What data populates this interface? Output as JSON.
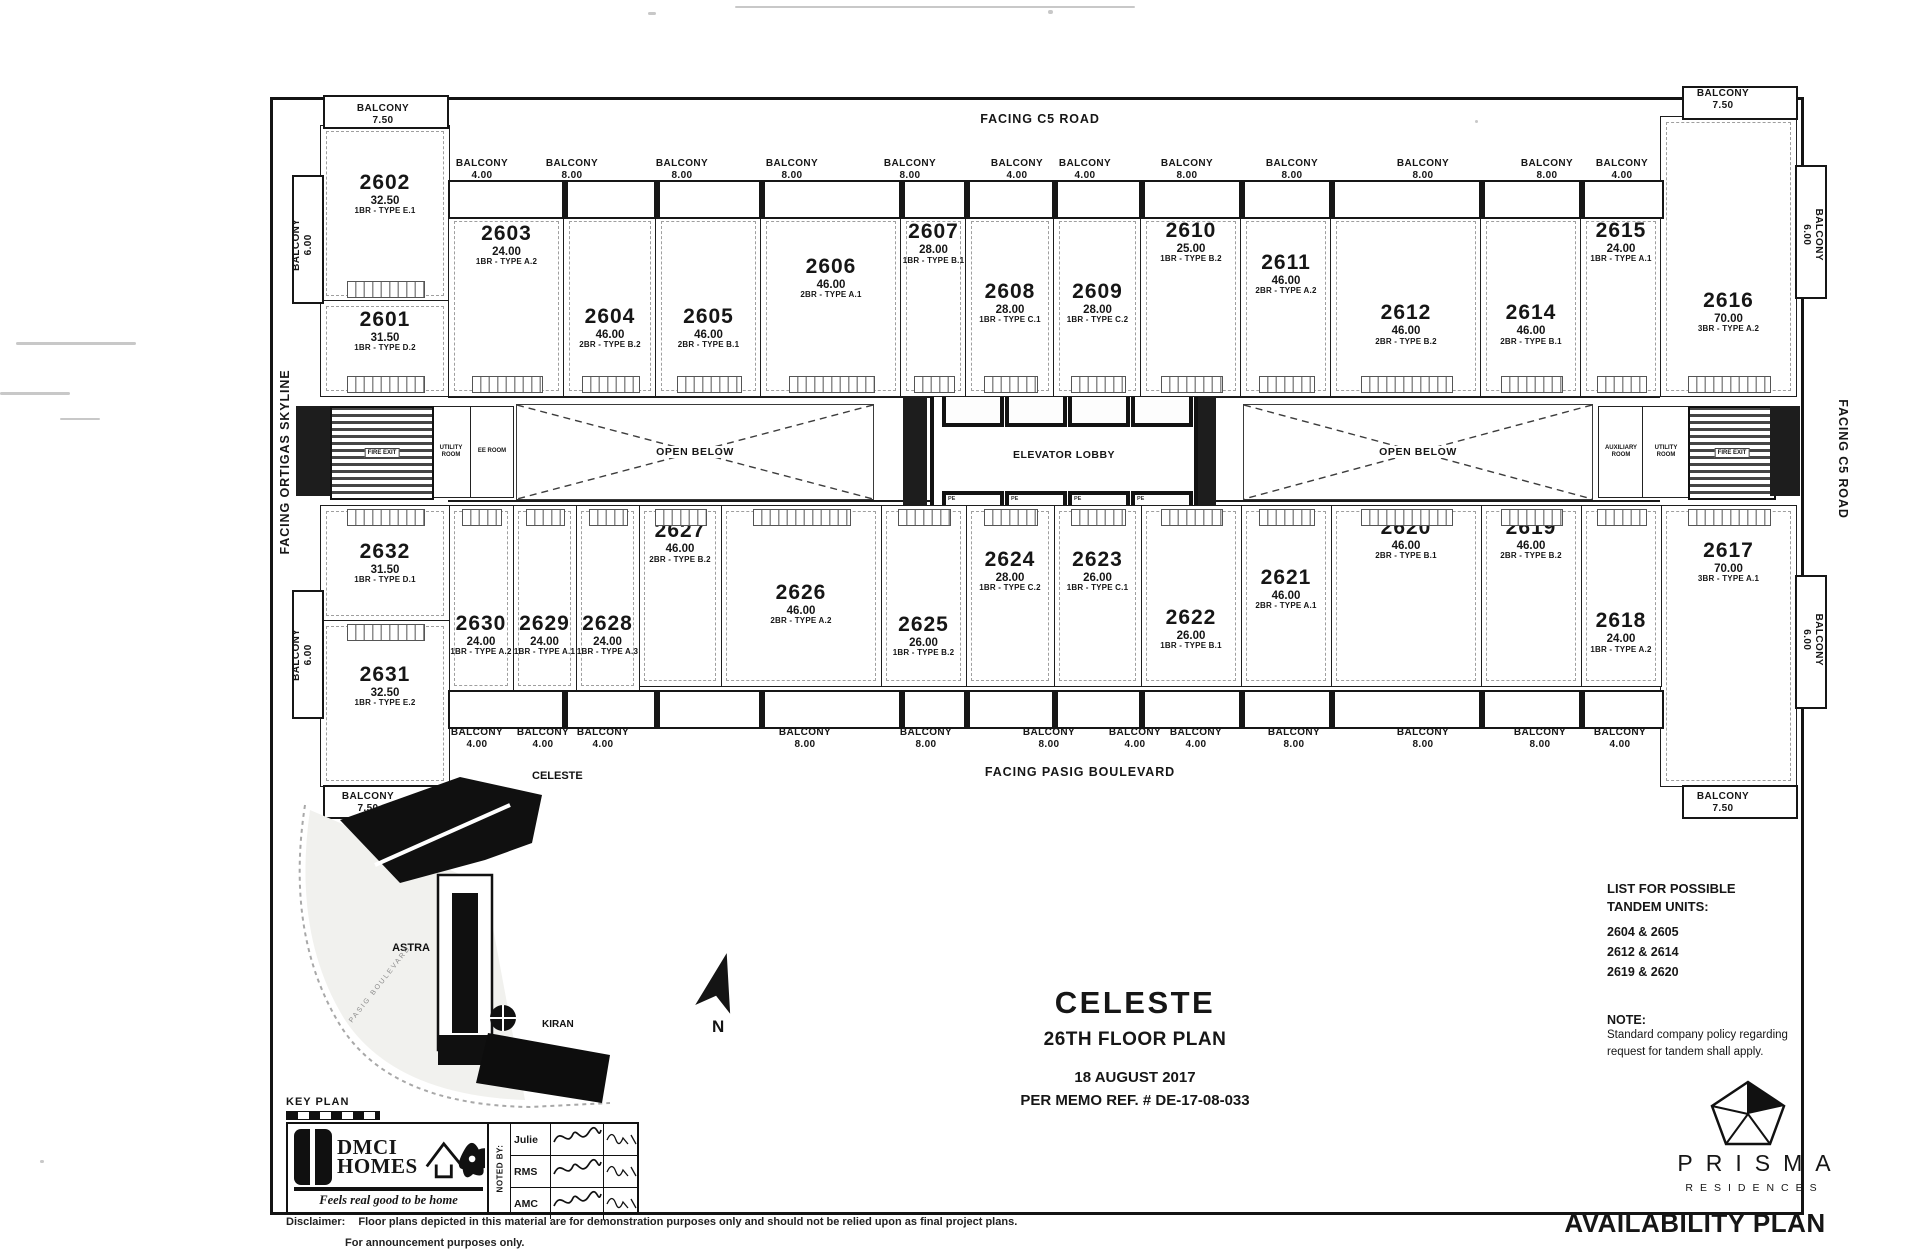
{
  "labels": {
    "balcony_word": "BALCONY",
    "elevator_lobby": "ELEVATOR LOBBY",
    "open_below": "OPEN BELOW",
    "fire_exit": "FIRE EXIT",
    "elevator_cell": "PE"
  },
  "orientation": {
    "top": "FACING C5 ROAD",
    "bottom": "FACING PASIG BOULEVARD",
    "left": "FACING ORTIGAS SKYLINE",
    "right": "FACING C5 ROAD"
  },
  "title_block": {
    "tower": "CELESTE",
    "floor": "26TH FLOOR PLAN",
    "date": "18 AUGUST 2017",
    "memo": "PER MEMO REF. #  DE-17-08-033"
  },
  "tandem": {
    "title_line1": "LIST FOR POSSIBLE",
    "title_line2": "TANDEM UNITS:",
    "pairs": [
      "2604 & 2605",
      "2612 & 2614",
      "2619 & 2620"
    ],
    "note_label": "NOTE:",
    "note_line1": "Standard company policy regarding",
    "note_line2": "request for tandem shall apply."
  },
  "key_plan": {
    "label": "KEY PLAN",
    "celeste": "CELESTE",
    "astra": "ASTRA",
    "kiran": "KIRAN",
    "street": "PASIG BOULEVARD",
    "north": "N"
  },
  "branding": {
    "dmci_line1": "DMCI",
    "dmci_line2": "HOMES",
    "dmci_tagline": "Feels real good to be home",
    "noted_by": "NOTED BY:",
    "noted_rows": [
      "Julie",
      "RMS",
      "AMC"
    ],
    "prisma": "PRISMA",
    "prisma_sub": "RESIDENCES",
    "availability": "AVAILABILITY PLAN"
  },
  "disclaimer": {
    "label": "Disclaimer:",
    "line1": "Floor plans depicted in this material are for demonstration purposes only and should not be relied upon as final project plans.",
    "line2": "For announcement purposes only."
  },
  "plan": {
    "units": [
      {
        "n": "2602",
        "a": "32.50",
        "t": "1BR - TYPE E.1",
        "x": 320,
        "y": 125,
        "w": 128,
        "h": 175,
        "ly": 26,
        "row": "top"
      },
      {
        "n": "2601",
        "a": "31.50",
        "t": "1BR - TYPE D.2",
        "x": 320,
        "y": 300,
        "w": 128,
        "h": 95,
        "ly": 8,
        "row": "top"
      },
      {
        "n": "2603",
        "a": "24.00",
        "t": "1BR - TYPE A.2",
        "x": 448,
        "y": 215,
        "w": 115,
        "h": 180,
        "ly": 4,
        "row": "top"
      },
      {
        "n": "2604",
        "a": "46.00",
        "t": "2BR - TYPE B.2",
        "x": 563,
        "y": 215,
        "w": 92,
        "h": 180,
        "ly": 50,
        "row": "top"
      },
      {
        "n": "2605",
        "a": "46.00",
        "t": "2BR - TYPE B.1",
        "x": 655,
        "y": 215,
        "w": 105,
        "h": 180,
        "ly": 50,
        "row": "top"
      },
      {
        "n": "2606",
        "a": "46.00",
        "t": "2BR - TYPE A.1",
        "x": 760,
        "y": 215,
        "w": 140,
        "h": 180,
        "ly": 22,
        "row": "top"
      },
      {
        "n": "2607",
        "a": "28.00",
        "t": "1BR - TYPE B.1",
        "x": 900,
        "y": 215,
        "w": 65,
        "h": 180,
        "ly": 3,
        "row": "top"
      },
      {
        "n": "2608",
        "a": "28.00",
        "t": "1BR - TYPE C.1",
        "x": 965,
        "y": 215,
        "w": 88,
        "h": 180,
        "ly": 36,
        "row": "top"
      },
      {
        "n": "2609",
        "a": "28.00",
        "t": "1BR - TYPE C.2",
        "x": 1053,
        "y": 215,
        "w": 87,
        "h": 180,
        "ly": 36,
        "row": "top"
      },
      {
        "n": "2610",
        "a": "25.00",
        "t": "1BR - TYPE B.2",
        "x": 1140,
        "y": 215,
        "w": 100,
        "h": 180,
        "ly": 2,
        "row": "top"
      },
      {
        "n": "2611",
        "a": "46.00",
        "t": "2BR - TYPE A.2",
        "x": 1240,
        "y": 215,
        "w": 90,
        "h": 180,
        "ly": 20,
        "row": "top"
      },
      {
        "n": "2612",
        "a": "46.00",
        "t": "2BR - TYPE B.2",
        "x": 1330,
        "y": 215,
        "w": 150,
        "h": 180,
        "ly": 48,
        "row": "top"
      },
      {
        "n": "2614",
        "a": "46.00",
        "t": "2BR - TYPE B.1",
        "x": 1480,
        "y": 215,
        "w": 100,
        "h": 180,
        "ly": 48,
        "row": "top"
      },
      {
        "n": "2615",
        "a": "24.00",
        "t": "1BR - TYPE A.1",
        "x": 1580,
        "y": 215,
        "w": 80,
        "h": 180,
        "ly": 2,
        "row": "top"
      },
      {
        "n": "2616",
        "a": "70.00",
        "t": "3BR - TYPE A.2",
        "x": 1660,
        "y": 116,
        "w": 135,
        "h": 279,
        "ly": 62,
        "row": "top"
      },
      {
        "n": "2617",
        "a": "70.00",
        "t": "3BR - TYPE A.1",
        "x": 1660,
        "y": 505,
        "w": 135,
        "h": 280,
        "ly": 12,
        "row": "bottom"
      },
      {
        "n": "2618",
        "a": "24.00",
        "t": "1BR - TYPE A.2",
        "x": 1580,
        "y": 505,
        "w": 80,
        "h": 180,
        "ly": 58,
        "row": "bottom"
      },
      {
        "n": "2619",
        "a": "46.00",
        "t": "2BR - TYPE B.2",
        "x": 1480,
        "y": 505,
        "w": 100,
        "h": 180,
        "ly": 6,
        "row": "bottom"
      },
      {
        "n": "2620",
        "a": "46.00",
        "t": "2BR - TYPE B.1",
        "x": 1330,
        "y": 505,
        "w": 150,
        "h": 180,
        "ly": 6,
        "row": "bottom"
      },
      {
        "n": "2621",
        "a": "46.00",
        "t": "2BR - TYPE A.1",
        "x": 1240,
        "y": 505,
        "w": 90,
        "h": 180,
        "ly": 34,
        "row": "bottom"
      },
      {
        "n": "2622",
        "a": "26.00",
        "t": "1BR - TYPE B.1",
        "x": 1140,
        "y": 505,
        "w": 100,
        "h": 180,
        "ly": 56,
        "row": "bottom"
      },
      {
        "n": "2623",
        "a": "26.00",
        "t": "1BR - TYPE C.1",
        "x": 1053,
        "y": 505,
        "w": 87,
        "h": 180,
        "ly": 24,
        "row": "bottom"
      },
      {
        "n": "2624",
        "a": "28.00",
        "t": "1BR - TYPE C.2",
        "x": 965,
        "y": 505,
        "w": 88,
        "h": 180,
        "ly": 24,
        "row": "bottom"
      },
      {
        "n": "2625",
        "a": "26.00",
        "t": "1BR - TYPE B.2",
        "x": 880,
        "y": 505,
        "w": 85,
        "h": 180,
        "ly": 60,
        "row": "bottom"
      },
      {
        "n": "2626",
        "a": "46.00",
        "t": "2BR - TYPE A.2",
        "x": 720,
        "y": 505,
        "w": 160,
        "h": 180,
        "ly": 42,
        "row": "bottom"
      },
      {
        "n": "2627",
        "a": "46.00",
        "t": "2BR - TYPE B.2",
        "x": 638,
        "y": 505,
        "w": 82,
        "h": 180,
        "ly": 8,
        "row": "bottom"
      },
      {
        "n": "2628",
        "a": "24.00",
        "t": "1BR - TYPE A.3",
        "x": 575,
        "y": 505,
        "w": 63,
        "h": 185,
        "ly": 58,
        "row": "bottom"
      },
      {
        "n": "2629",
        "a": "24.00",
        "t": "1BR - TYPE A.1",
        "x": 512,
        "y": 505,
        "w": 63,
        "h": 185,
        "ly": 58,
        "row": "bottom"
      },
      {
        "n": "2630",
        "a": "24.00",
        "t": "1BR - TYPE A.2",
        "x": 448,
        "y": 505,
        "w": 64,
        "h": 185,
        "ly": 58,
        "row": "bottom"
      },
      {
        "n": "2632",
        "a": "31.50",
        "t": "1BR - TYPE D.1",
        "x": 320,
        "y": 505,
        "w": 128,
        "h": 115,
        "ly": 30,
        "row": "bottom"
      },
      {
        "n": "2631",
        "a": "32.50",
        "t": "1BR - TYPE E.2",
        "x": 320,
        "y": 620,
        "w": 128,
        "h": 165,
        "ly": 26,
        "row": "bottom"
      }
    ],
    "balcony_strips": [
      {
        "x": 448,
        "y": 180,
        "w": 1212,
        "h": 35,
        "div": [
          563,
          655,
          760,
          900,
          965,
          1053,
          1140,
          1240,
          1330,
          1480,
          1580
        ]
      },
      {
        "x": 448,
        "y": 690,
        "w": 1212,
        "h": 35,
        "div": [
          563,
          655,
          760,
          900,
          965,
          1053,
          1140,
          1240,
          1330,
          1480,
          1580
        ]
      },
      {
        "x": 323,
        "y": 95,
        "w": 122,
        "h": 30
      },
      {
        "x": 1682,
        "y": 86,
        "w": 112,
        "h": 30
      },
      {
        "x": 323,
        "y": 785,
        "w": 122,
        "h": 30
      },
      {
        "x": 1682,
        "y": 785,
        "w": 112,
        "h": 30
      },
      {
        "x": 292,
        "y": 175,
        "w": 28,
        "h": 125
      },
      {
        "x": 292,
        "y": 590,
        "w": 28,
        "h": 125
      },
      {
        "x": 1795,
        "y": 165,
        "w": 28,
        "h": 130
      },
      {
        "x": 1795,
        "y": 575,
        "w": 28,
        "h": 130
      }
    ],
    "balcony_labels": [
      {
        "x": 383,
        "y": 103,
        "v": "7.50"
      },
      {
        "x": 482,
        "y": 158,
        "v": "4.00"
      },
      {
        "x": 572,
        "y": 158,
        "v": "8.00"
      },
      {
        "x": 682,
        "y": 158,
        "v": "8.00"
      },
      {
        "x": 792,
        "y": 158,
        "v": "8.00"
      },
      {
        "x": 910,
        "y": 158,
        "v": "8.00"
      },
      {
        "x": 1017,
        "y": 158,
        "v": "4.00"
      },
      {
        "x": 1085,
        "y": 158,
        "v": "4.00"
      },
      {
        "x": 1187,
        "y": 158,
        "v": "8.00"
      },
      {
        "x": 1292,
        "y": 158,
        "v": "8.00"
      },
      {
        "x": 1423,
        "y": 158,
        "v": "8.00"
      },
      {
        "x": 1547,
        "y": 158,
        "v": "8.00"
      },
      {
        "x": 1622,
        "y": 158,
        "v": "4.00"
      },
      {
        "x": 1723,
        "y": 88,
        "v": "7.50"
      },
      {
        "x": 368,
        "y": 791,
        "v": "7.50"
      },
      {
        "x": 477,
        "y": 727,
        "v": "4.00"
      },
      {
        "x": 543,
        "y": 727,
        "v": "4.00"
      },
      {
        "x": 603,
        "y": 727,
        "v": "4.00"
      },
      {
        "x": 805,
        "y": 727,
        "v": "8.00"
      },
      {
        "x": 926,
        "y": 727,
        "v": "8.00"
      },
      {
        "x": 1049,
        "y": 727,
        "v": "8.00"
      },
      {
        "x": 1135,
        "y": 727,
        "v": "4.00"
      },
      {
        "x": 1196,
        "y": 727,
        "v": "4.00"
      },
      {
        "x": 1294,
        "y": 727,
        "v": "8.00"
      },
      {
        "x": 1423,
        "y": 727,
        "v": "8.00"
      },
      {
        "x": 1540,
        "y": 727,
        "v": "8.00"
      },
      {
        "x": 1620,
        "y": 727,
        "v": "4.00"
      },
      {
        "x": 1723,
        "y": 791,
        "v": "7.50"
      },
      {
        "x": 303,
        "y": 233,
        "v": "6.00",
        "rot": -90
      },
      {
        "x": 303,
        "y": 643,
        "v": "6.00",
        "rot": -90
      },
      {
        "x": 1812,
        "y": 223,
        "v": "6.00",
        "rot": 90
      },
      {
        "x": 1812,
        "y": 628,
        "v": "6.00",
        "rot": 90
      }
    ],
    "corridors": [
      {
        "x": 448,
        "y": 396,
        "w": 1212
      },
      {
        "x": 448,
        "y": 500,
        "w": 1212
      }
    ],
    "open_below": [
      {
        "x": 516,
        "y": 404,
        "w": 356,
        "h": 94
      },
      {
        "x": 1243,
        "y": 404,
        "w": 348,
        "h": 94
      }
    ],
    "rooms": [
      {
        "x": 430,
        "y": 406,
        "w": 40,
        "h": 90,
        "label": "UTILITY ROOM"
      },
      {
        "x": 470,
        "y": 406,
        "w": 42,
        "h": 90,
        "label": "EE ROOM"
      },
      {
        "x": 1598,
        "y": 406,
        "w": 44,
        "h": 90,
        "label": "AUXILIARY ROOM"
      },
      {
        "x": 1642,
        "y": 406,
        "w": 46,
        "h": 90,
        "label": "UTILITY ROOM"
      }
    ],
    "stairs": [
      {
        "x": 330,
        "y": 406,
        "w": 100,
        "h": 90
      },
      {
        "x": 1688,
        "y": 406,
        "w": 84,
        "h": 90
      }
    ],
    "dark_blocks": [
      {
        "x": 296,
        "y": 406,
        "w": 34,
        "h": 90
      },
      {
        "x": 1770,
        "y": 406,
        "w": 30,
        "h": 90
      },
      {
        "x": 903,
        "y": 352,
        "w": 24,
        "h": 198
      },
      {
        "x": 1192,
        "y": 352,
        "w": 24,
        "h": 198
      }
    ],
    "elevator": {
      "x": 930,
      "y": 345,
      "w": 260,
      "h": 212,
      "cell_xs": [
        8,
        71,
        134,
        197
      ],
      "cell_w": 54,
      "cell_h": 62,
      "row_top": 8,
      "row_bottom": 142
    },
    "artifacts": [
      {
        "x": 16,
        "y": 342,
        "w": 120,
        "h": 3
      },
      {
        "x": 0,
        "y": 392,
        "w": 70,
        "h": 3
      },
      {
        "x": 60,
        "y": 418,
        "w": 40,
        "h": 2
      },
      {
        "x": 735,
        "y": 6,
        "w": 400,
        "h": 2
      },
      {
        "x": 1048,
        "y": 10,
        "w": 5,
        "h": 4
      },
      {
        "x": 648,
        "y": 12,
        "w": 8,
        "h": 3
      },
      {
        "x": 40,
        "y": 1160,
        "w": 4,
        "h": 3
      },
      {
        "x": 1475,
        "y": 120,
        "w": 3,
        "h": 3
      }
    ]
  }
}
